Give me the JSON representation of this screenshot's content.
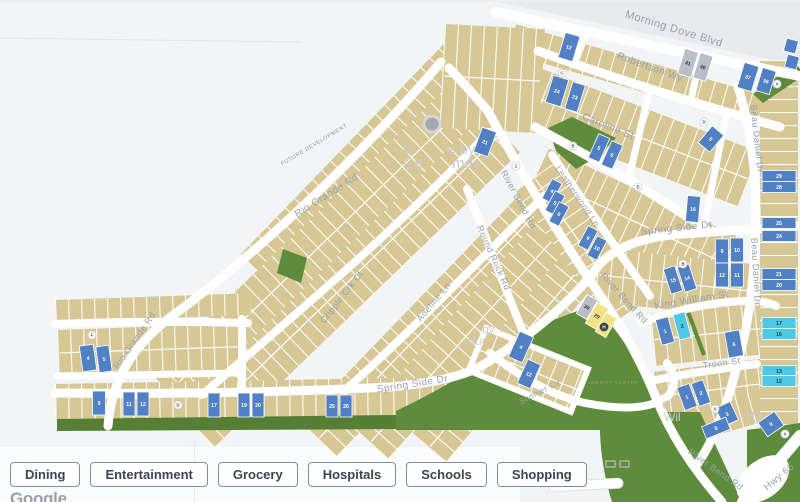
{
  "colors": {
    "blue": "#5180c4",
    "cyan": "#4cc9e6",
    "gray": "#b9bfc6",
    "yellow": "#f4e385",
    "tan": "#d6c795",
    "green": "#5e8c3c",
    "street_label": "#99a1ab",
    "bg": "#f2f4f6"
  },
  "map": {
    "street_labels": [
      {
        "t": "Morning Dove Blvd",
        "x": 673,
        "y": 30,
        "r": 17,
        "s": 11
      },
      {
        "t": "Robertson Wy",
        "x": 649,
        "y": 68,
        "r": 20,
        "s": 10
      },
      {
        "t": "Caroline St",
        "x": 607,
        "y": 127,
        "r": 22,
        "s": 10
      },
      {
        "t": "Leatherwood Ln",
        "x": 575,
        "y": 196,
        "r": 56,
        "s": 9
      },
      {
        "t": "River Bend Rd",
        "x": 516,
        "y": 199,
        "r": 62,
        "s": 9
      },
      {
        "t": "River Bend Rd",
        "x": 622,
        "y": 298,
        "r": 48,
        "s": 9
      },
      {
        "t": "River Bend Rd",
        "x": 714,
        "y": 470,
        "r": 35,
        "s": 9
      },
      {
        "t": "Round Rock Rd",
        "x": 491,
        "y": 257,
        "r": 66,
        "s": 9
      },
      {
        "t": "Rio Grande Rd",
        "x": 328,
        "y": 196,
        "r": -32,
        "s": 10
      },
      {
        "t": "Rio Grande Rd",
        "x": 137,
        "y": 340,
        "r": -55,
        "s": 9
      },
      {
        "t": "Cripple Crk Ct",
        "x": 344,
        "y": 297,
        "r": -52,
        "s": 9
      },
      {
        "t": "Adeline Ln",
        "x": 436,
        "y": 302,
        "r": -50,
        "s": 9
      },
      {
        "t": "Spring Side Dr",
        "x": 413,
        "y": 385,
        "r": -9,
        "s": 10
      },
      {
        "t": "Spring Side Dr",
        "x": 677,
        "y": 229,
        "r": -6,
        "s": 10
      },
      {
        "t": "Sonnier Cir",
        "x": 541,
        "y": 392,
        "r": -27,
        "s": 8
      },
      {
        "t": "King William St",
        "x": 692,
        "y": 301,
        "r": -9,
        "s": 10
      },
      {
        "t": "Troon St",
        "x": 722,
        "y": 364,
        "r": -8,
        "s": 9
      },
      {
        "t": "Beau Daniel Dr",
        "x": 754,
        "y": 137,
        "r": 84,
        "s": 9
      },
      {
        "t": "Beau Daniel Dr",
        "x": 753,
        "y": 270,
        "r": 87,
        "s": 9
      },
      {
        "t": "Hwy 66",
        "x": 781,
        "y": 477,
        "r": -40,
        "s": 10
      }
    ],
    "area_labels": [
      {
        "t": "FUTURE DEVELOPMENT",
        "x": 315,
        "y": 144,
        "r": -31,
        "s": 5.5,
        "c": "#8d93a0",
        "ls": 0.6
      },
      {
        "t": "AMENITY CENTER",
        "x": 613,
        "y": 382,
        "r": 0,
        "s": 4.5,
        "c": "#8fa077",
        "ls": 0.8
      }
    ],
    "partial_labels": [
      {
        "t": "C",
        "x": 403,
        "y": 152,
        "s": 15
      },
      {
        "t": "e by",
        "x": 447,
        "y": 152,
        "s": 15
      },
      {
        "t": "Ge",
        "x": 403,
        "y": 166,
        "s": 15
      },
      {
        "t": "mes",
        "x": 452,
        "y": 166,
        "s": 15
      },
      {
        "t": "by T",
        "x": 482,
        "y": 331,
        "s": 12
      },
      {
        "t": "atur",
        "x": 465,
        "y": 343,
        "s": 12
      },
      {
        "t": "Cr",
        "x": 662,
        "y": 407,
        "s": 12
      },
      {
        "t": "Wil",
        "x": 664,
        "y": 419,
        "s": 12
      },
      {
        "t": "Ho",
        "x": 746,
        "y": 418,
        "s": 12
      }
    ],
    "lots": [
      {
        "n": "12",
        "x": 569,
        "y": 45,
        "w": 15,
        "h": 26,
        "r": 17,
        "c": "blue"
      },
      {
        "n": "24",
        "x": 557,
        "y": 89,
        "w": 16,
        "h": 28,
        "r": 17,
        "c": "blue"
      },
      {
        "n": "23",
        "x": 575,
        "y": 95,
        "w": 13,
        "h": 28,
        "r": 17,
        "c": "blue"
      },
      {
        "n": "41",
        "x": 688,
        "y": 61,
        "w": 14,
        "h": 26,
        "r": 17,
        "c": "gray"
      },
      {
        "n": "40",
        "x": 703,
        "y": 65,
        "w": 13,
        "h": 26,
        "r": 17,
        "c": "gray"
      },
      {
        "n": "37",
        "x": 748,
        "y": 75,
        "w": 15,
        "h": 26,
        "r": 17,
        "c": "blue"
      },
      {
        "n": "36",
        "x": 766,
        "y": 79,
        "w": 14,
        "h": 24,
        "r": 17,
        "c": "blue"
      },
      {
        "n": "",
        "x": 791,
        "y": 44,
        "w": 12,
        "h": 13,
        "r": 15,
        "c": "blue"
      },
      {
        "n": "",
        "x": 792,
        "y": 60,
        "w": 12,
        "h": 13,
        "r": 15,
        "c": "blue"
      },
      {
        "n": "21",
        "x": 485,
        "y": 140,
        "w": 15,
        "h": 26,
        "r": 20,
        "c": "blue"
      },
      {
        "n": "5",
        "x": 599,
        "y": 146,
        "w": 12,
        "h": 26,
        "r": 24,
        "c": "blue"
      },
      {
        "n": "6",
        "x": 612,
        "y": 153,
        "w": 12,
        "h": 26,
        "r": 24,
        "c": "blue"
      },
      {
        "n": "6",
        "x": 711,
        "y": 137,
        "w": 15,
        "h": 22,
        "r": 40,
        "c": "blue"
      },
      {
        "n": "4",
        "x": 552,
        "y": 189,
        "w": 11,
        "h": 22,
        "r": 28,
        "c": "blue"
      },
      {
        "n": "5",
        "x": 555,
        "y": 201,
        "w": 11,
        "h": 22,
        "r": 28,
        "c": "blue"
      },
      {
        "n": "6",
        "x": 559,
        "y": 212,
        "w": 11,
        "h": 22,
        "r": 28,
        "c": "blue"
      },
      {
        "n": "9",
        "x": 588,
        "y": 236,
        "w": 11,
        "h": 22,
        "r": 28,
        "c": "blue"
      },
      {
        "n": "10",
        "x": 597,
        "y": 246,
        "w": 11,
        "h": 22,
        "r": 28,
        "c": "blue"
      },
      {
        "n": "16",
        "x": 693,
        "y": 207,
        "w": 13,
        "h": 26,
        "r": 5,
        "c": "blue"
      },
      {
        "n": "9",
        "x": 722,
        "y": 249,
        "w": 13,
        "h": 24,
        "r": 0,
        "c": "blue"
      },
      {
        "n": "10",
        "x": 737,
        "y": 248,
        "w": 13,
        "h": 24,
        "r": 0,
        "c": "blue"
      },
      {
        "n": "12",
        "x": 722,
        "y": 273,
        "w": 13,
        "h": 24,
        "r": 0,
        "c": "blue"
      },
      {
        "n": "11",
        "x": 737,
        "y": 273,
        "w": 13,
        "h": 24,
        "r": 0,
        "c": "blue"
      },
      {
        "n": "15",
        "x": 673,
        "y": 278,
        "w": 12,
        "h": 26,
        "r": -18,
        "c": "blue"
      },
      {
        "n": "14",
        "x": 687,
        "y": 276,
        "w": 12,
        "h": 26,
        "r": -18,
        "c": "blue"
      },
      {
        "n": "30",
        "x": 587,
        "y": 305,
        "w": 12,
        "h": 22,
        "r": 30,
        "c": "gray"
      },
      {
        "n": "29",
        "x": 597,
        "y": 314,
        "w": 13,
        "h": 24,
        "r": 30,
        "c": "yellow"
      },
      {
        "n": "",
        "x": 606,
        "y": 323,
        "w": 12,
        "h": 22,
        "r": 30,
        "c": "yellow"
      },
      {
        "n": "4",
        "x": 521,
        "y": 345,
        "w": 15,
        "h": 28,
        "r": 24,
        "c": "blue"
      },
      {
        "n": "12",
        "x": 529,
        "y": 372,
        "w": 14,
        "h": 26,
        "r": 24,
        "c": "blue"
      },
      {
        "n": "1",
        "x": 665,
        "y": 329,
        "w": 13,
        "h": 26,
        "r": -15,
        "c": "blue"
      },
      {
        "n": "2",
        "x": 682,
        "y": 324,
        "w": 12,
        "h": 26,
        "r": -15,
        "c": "cyan"
      },
      {
        "n": "6",
        "x": 734,
        "y": 342,
        "w": 15,
        "h": 26,
        "r": -10,
        "c": "blue"
      },
      {
        "n": "1",
        "x": 687,
        "y": 395,
        "w": 13,
        "h": 24,
        "r": -20,
        "c": "blue"
      },
      {
        "n": "2",
        "x": 701,
        "y": 391,
        "w": 12,
        "h": 24,
        "r": -20,
        "c": "blue"
      },
      {
        "n": "3",
        "x": 727,
        "y": 412,
        "w": 16,
        "h": 20,
        "r": -25,
        "c": "blue"
      },
      {
        "n": "6",
        "x": 716,
        "y": 426,
        "w": 26,
        "h": 13,
        "r": -22,
        "c": "blue"
      },
      {
        "n": "9",
        "x": 771,
        "y": 422,
        "w": 20,
        "h": 17,
        "r": -35,
        "c": "blue"
      },
      {
        "n": "4",
        "x": 88,
        "y": 356,
        "w": 14,
        "h": 26,
        "r": -8,
        "c": "blue"
      },
      {
        "n": "5",
        "x": 104,
        "y": 357,
        "w": 13,
        "h": 26,
        "r": -8,
        "c": "blue"
      },
      {
        "n": "9",
        "x": 99,
        "y": 401,
        "w": 13,
        "h": 24,
        "r": 0,
        "c": "blue"
      },
      {
        "n": "11",
        "x": 129,
        "y": 402,
        "w": 12,
        "h": 24,
        "r": 0,
        "c": "blue"
      },
      {
        "n": "12",
        "x": 143,
        "y": 402,
        "w": 12,
        "h": 24,
        "r": 0,
        "c": "blue"
      },
      {
        "n": "17",
        "x": 214,
        "y": 403,
        "w": 12,
        "h": 24,
        "r": 0,
        "c": "blue"
      },
      {
        "n": "19",
        "x": 244,
        "y": 403,
        "w": 12,
        "h": 24,
        "r": 0,
        "c": "blue"
      },
      {
        "n": "20",
        "x": 258,
        "y": 403,
        "w": 12,
        "h": 24,
        "r": 0,
        "c": "blue"
      },
      {
        "n": "25",
        "x": 332,
        "y": 404,
        "w": 12,
        "h": 22,
        "r": 0,
        "c": "blue"
      },
      {
        "n": "26",
        "x": 346,
        "y": 404,
        "w": 12,
        "h": 22,
        "r": 0,
        "c": "blue"
      },
      {
        "n": "29",
        "x": 779,
        "y": 174,
        "w": 34,
        "h": 11,
        "r": 0,
        "c": "blue"
      },
      {
        "n": "28",
        "x": 779,
        "y": 185,
        "w": 34,
        "h": 11,
        "r": 0,
        "c": "blue"
      },
      {
        "n": "25",
        "x": 779,
        "y": 221,
        "w": 34,
        "h": 11,
        "r": 0,
        "c": "blue"
      },
      {
        "n": "24",
        "x": 779,
        "y": 234,
        "w": 34,
        "h": 11,
        "r": 0,
        "c": "blue"
      },
      {
        "n": "21",
        "x": 779,
        "y": 272,
        "w": 34,
        "h": 11,
        "r": 0,
        "c": "blue"
      },
      {
        "n": "20",
        "x": 779,
        "y": 283,
        "w": 34,
        "h": 11,
        "r": 0,
        "c": "blue"
      },
      {
        "n": "17",
        "x": 779,
        "y": 321,
        "w": 34,
        "h": 11,
        "r": 0,
        "c": "cyan"
      },
      {
        "n": "16",
        "x": 779,
        "y": 332,
        "w": 34,
        "h": 11,
        "r": 0,
        "c": "cyan"
      },
      {
        "n": "13",
        "x": 779,
        "y": 369,
        "w": 34,
        "h": 11,
        "r": 0,
        "c": "cyan"
      },
      {
        "n": "12",
        "x": 779,
        "y": 379,
        "w": 34,
        "h": 11,
        "r": 0,
        "c": "cyan"
      }
    ],
    "markers": [
      {
        "t": "C",
        "x": 562,
        "y": 71
      },
      {
        "t": "B",
        "x": 573,
        "y": 144
      },
      {
        "t": "E",
        "x": 638,
        "y": 185
      },
      {
        "t": "D",
        "x": 704,
        "y": 120
      },
      {
        "t": "A",
        "x": 777,
        "y": 82
      },
      {
        "t": "A",
        "x": 715,
        "y": 407
      },
      {
        "t": "A",
        "x": 785,
        "y": 432
      },
      {
        "t": "F",
        "x": 92,
        "y": 333
      },
      {
        "t": "D",
        "x": 178,
        "y": 403
      },
      {
        "t": "B",
        "x": 683,
        "y": 262
      },
      {
        "t": "1",
        "x": 516,
        "y": 164
      },
      {
        "t": "H",
        "x": 604,
        "y": 325,
        "dark": true
      }
    ]
  },
  "filters": {
    "buttons": [
      "Dining",
      "Entertainment",
      "Grocery",
      "Hospitals",
      "Schools",
      "Shopping"
    ]
  },
  "attribution": {
    "logo_text": "Google"
  }
}
